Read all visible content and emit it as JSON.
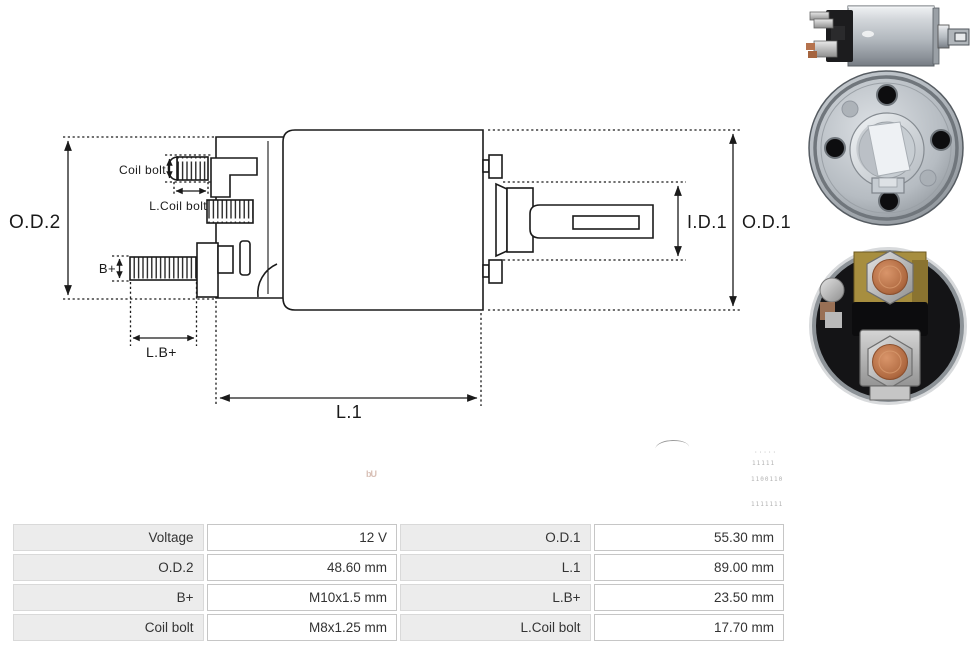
{
  "page": {
    "background": "#ffffff"
  },
  "drawing": {
    "stroke_color": "#1a1a1a",
    "labels": {
      "od2": "O.D.2",
      "coil_bolt": "Coil bolt",
      "l_coil_bolt": "L.Coil bolt",
      "b_plus": "B+",
      "l_b_plus": "L.B+",
      "l1": "L.1",
      "id1": "I.D.1",
      "od1": "O.D.1"
    }
  },
  "photos": {
    "side_view": "solenoid-side-view-photo",
    "front_view": "solenoid-front-face-photo",
    "rear_view": "solenoid-rear-terminals-photo"
  },
  "watermark": {
    "smudge": "bU",
    "fragments": [
      "·····",
      "11111",
      "1100110",
      "1111111"
    ]
  },
  "specs": {
    "colors": {
      "label_bg": "#ececec",
      "value_bg": "#ffffff",
      "border": "#c6c6c6",
      "text": "#333333"
    },
    "rows": [
      {
        "label_left": "Voltage",
        "value_left": "12 V",
        "label_right": "O.D.1",
        "value_right": "55.30 mm"
      },
      {
        "label_left": "O.D.2",
        "value_left": "48.60 mm",
        "label_right": "L.1",
        "value_right": "89.00 mm"
      },
      {
        "label_left": "B+",
        "value_left": "M10x1.5 mm",
        "label_right": "L.B+",
        "value_right": "23.50 mm"
      },
      {
        "label_left": "Coil bolt",
        "value_left": "M8x1.25 mm",
        "label_right": "L.Coil bolt",
        "value_right": "17.70 mm"
      }
    ]
  }
}
